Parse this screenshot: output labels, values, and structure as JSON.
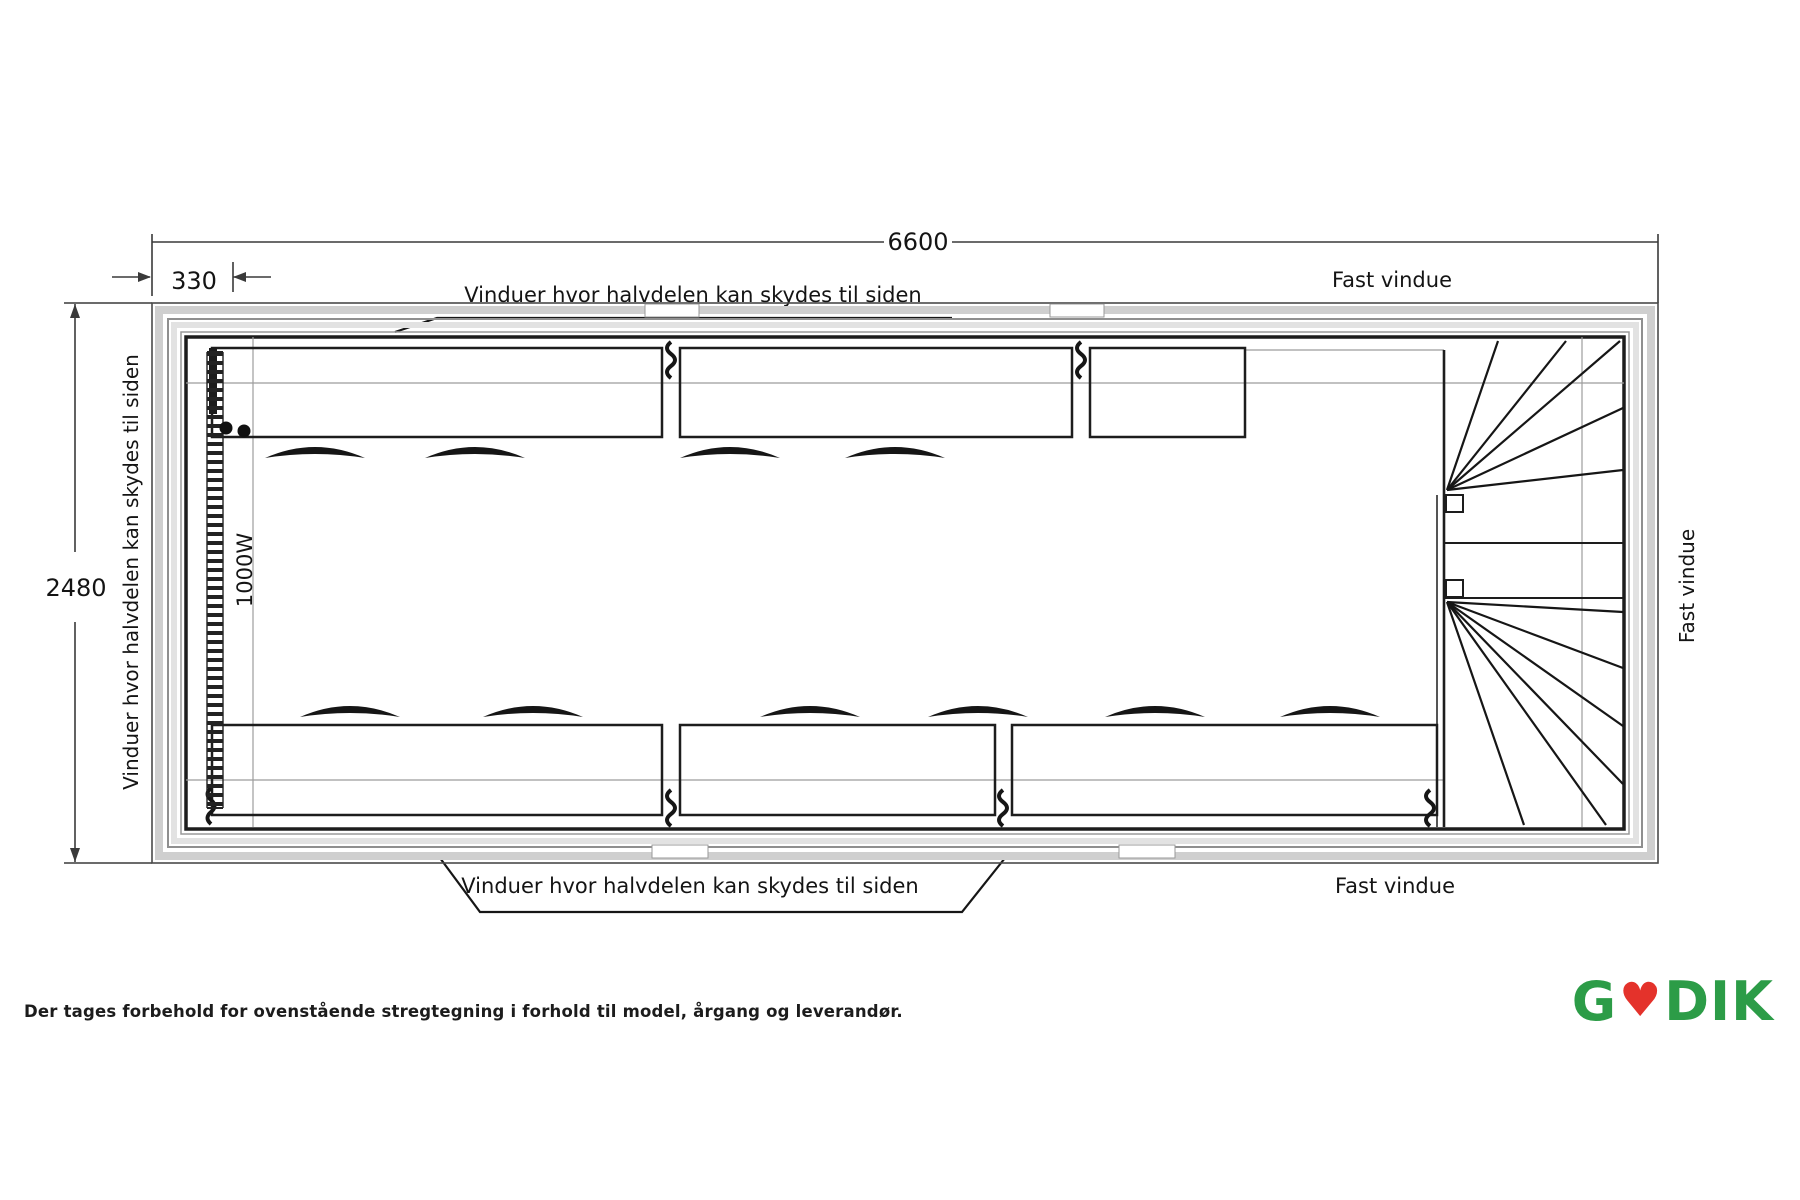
{
  "drawing": {
    "dimensions": {
      "total_length": "6600",
      "end_offset": "330",
      "width": "2480"
    },
    "heater_label": "1000W",
    "labels": {
      "sliding": "Vinduer hvor halvdelen kan skydes til siden",
      "fixed": "Fast vindue"
    }
  },
  "footer": {
    "disclaimer": "Der tages forbehold for ovenstående stregtegning i forhold til model, årgang og leverandør.",
    "logo": {
      "prefix": "G",
      "heart_icon": "♥",
      "suffix": "DIK"
    }
  },
  "colors": {
    "line": "#1d1d1d",
    "wall_band": "#cfcfcf",
    "logo_green": "#2c9c47",
    "logo_red": "#e4322b"
  }
}
